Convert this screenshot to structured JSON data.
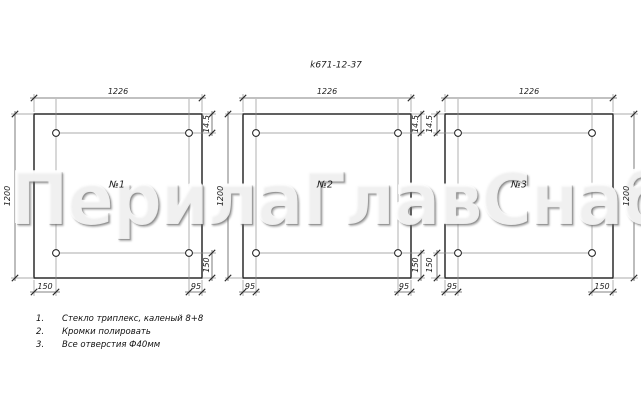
{
  "title": "k671-12-37",
  "watermark": "ПерилаГлавСнаб",
  "panels": [
    {
      "label": "№1",
      "width": "1226",
      "height": "1200",
      "hole_top": "14.5",
      "hole_bottom": "150",
      "bottom_left": "150",
      "bottom_right": "95"
    },
    {
      "label": "№2",
      "width": "1226",
      "height": "1200",
      "hole_top": "14.5",
      "hole_bottom": "150",
      "bottom_left": "95",
      "bottom_right": "95"
    },
    {
      "label": "№3",
      "width": "1226",
      "height": "1200",
      "hole_top": "14.5",
      "hole_bottom": "150",
      "bottom_left": "95",
      "bottom_right": "150"
    }
  ],
  "notes": [
    {
      "num": "1.",
      "text": "Стекло триплекс, каленый 8+8"
    },
    {
      "num": "2.",
      "text": "Кромки полировать"
    },
    {
      "num": "3.",
      "text": "Все отверстия Ф40мм"
    }
  ]
}
